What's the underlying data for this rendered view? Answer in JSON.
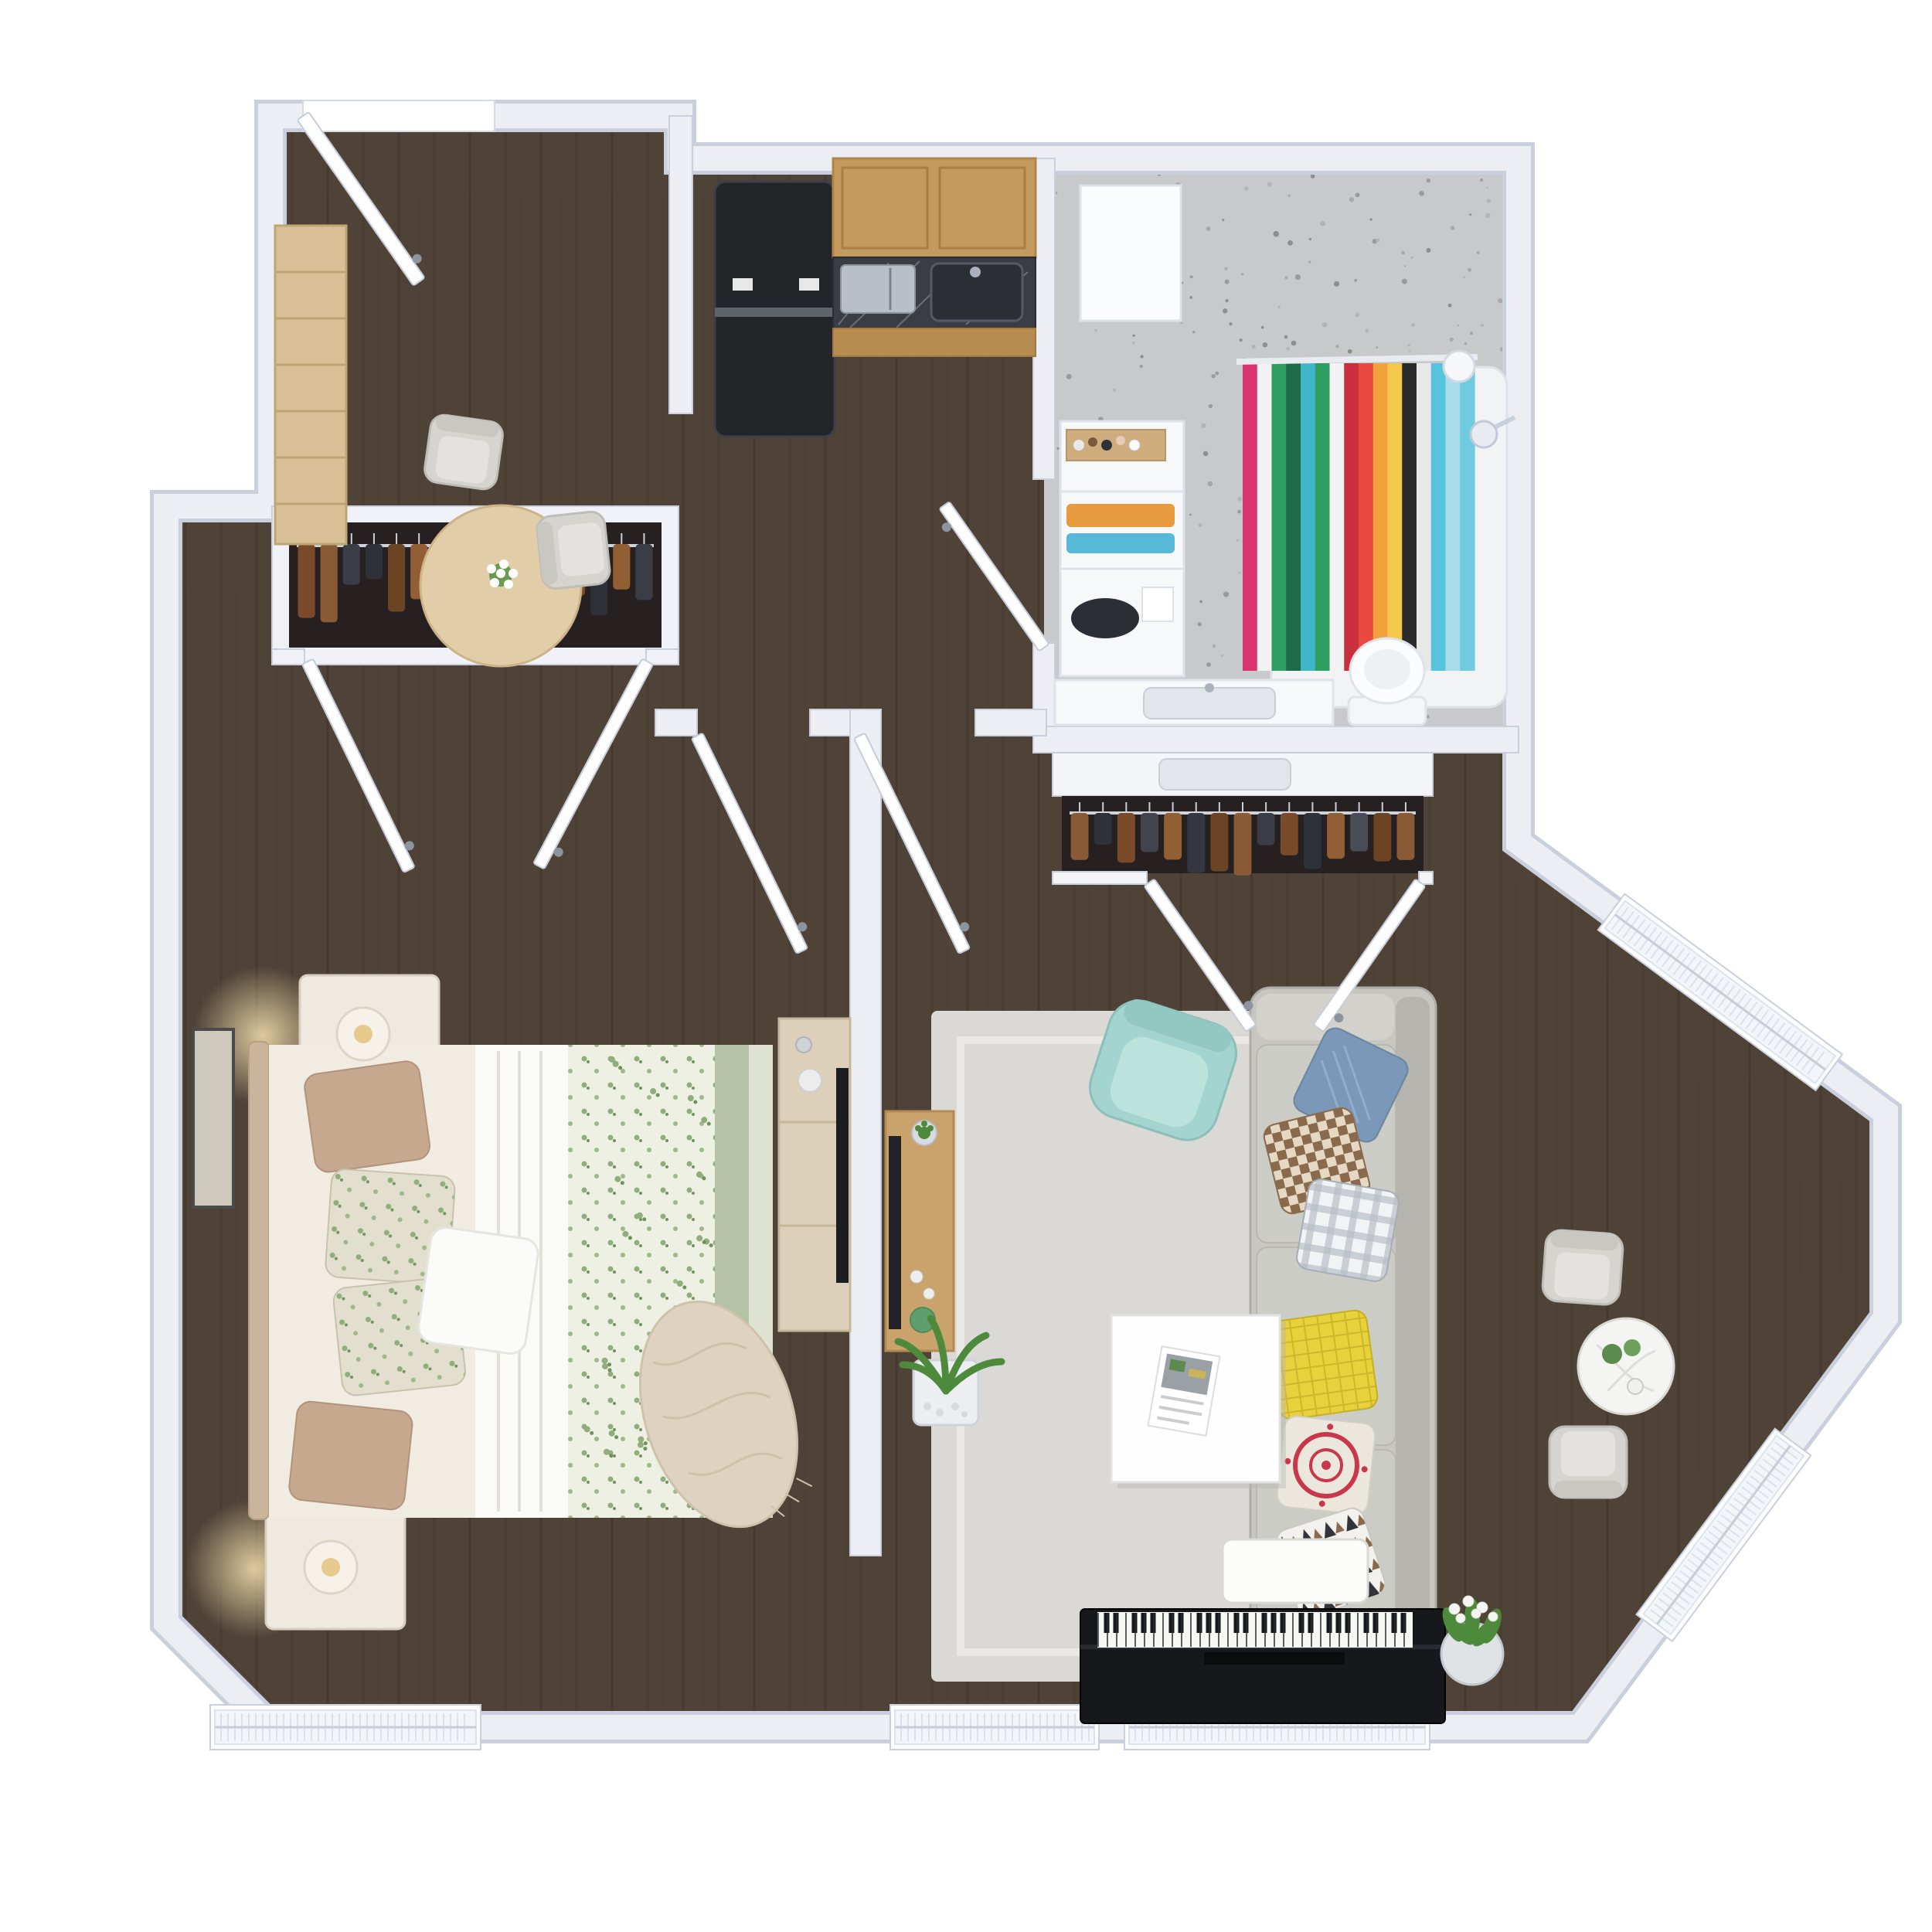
{
  "scene": {
    "kind": "3d-apartment-floor-plan-render",
    "background": "#ffffff"
  },
  "palette": {
    "floor_wood": "#4f4237",
    "plank_line": "#3f342a",
    "plank_light": "#5d4d3e",
    "wall_fill": "#eceef4",
    "wall_edge": "#c9cfdc",
    "bathroom_floor": "#c8c9ca",
    "rug": "#dad9d5",
    "white_furniture": "#fdfdfe"
  },
  "rooms": [
    {
      "name": "entry-dining-nook",
      "furniture": [
        "entry-door",
        "bookshelf",
        "dining-table",
        "dining-chair",
        "dining-chair",
        "flower-vase"
      ]
    },
    {
      "name": "kitchen",
      "furniture": [
        "refrigerator",
        "upper-cabinets",
        "marble-counter",
        "microwave",
        "kitchen-sink",
        "lower-cabinets"
      ]
    },
    {
      "name": "bathroom",
      "furniture": [
        "medicine-cabinet",
        "shelf-unit",
        "toiletries-tray",
        "towels",
        "shower-tray",
        "shower-curtain",
        "shower-head",
        "wall-light",
        "vanity-sink",
        "toilet"
      ]
    },
    {
      "name": "hallway",
      "furniture": [
        "bedroom-door",
        "living-room-door",
        "bathroom-door"
      ]
    },
    {
      "name": "bedroom",
      "furniture": [
        "double-bed",
        "floral-duvet",
        "throw-blanket",
        "pillows",
        "nightstand-lamp",
        "nightstand-lamp",
        "wall-art",
        "closet-with-clothes",
        "dresser",
        "tv",
        "window-blinds"
      ]
    },
    {
      "name": "living-room",
      "furniture": [
        "sofa",
        "sofa-pillows",
        "mint-armchair",
        "area-rug",
        "coffee-table",
        "magazine",
        "tv-console",
        "tv",
        "floor-plant",
        "closet-with-clothes",
        "bistro-table",
        "lounge-chair",
        "lounge-chair",
        "bay-windows"
      ]
    },
    {
      "name": "piano-nook",
      "furniture": [
        "upright-piano",
        "piano-bench",
        "tulip-plant",
        "window-blinds"
      ]
    }
  ],
  "kitchen": {
    "cabinet_wood": "#c49a5e",
    "cabinet_wood_dark": "#b08648",
    "counter_marble": "#3a3d44",
    "fridge": "#232529",
    "microwave": "#b9bec7"
  },
  "bathroom": {
    "shower_curtain": {
      "stripes": [
        "#d8356f",
        "#f2f2f2",
        "#2f9e63",
        "#1d6b4a",
        "#3fb7c9",
        "#2f9e63",
        "#f2f2f2",
        "#c92f3d",
        "#e84a3f",
        "#f2a23c",
        "#f4c84a",
        "#2b2b2b",
        "#e8e8e8",
        "#57c4de",
        "#a8dce8",
        "#6fcbe0"
      ]
    },
    "speckle_colors": [
      "#9b9b9b",
      "#a8a8a8",
      "#8e8e8e",
      "#b4b4b4"
    ],
    "towel_colors": [
      "#e89a3f",
      "#58b8d8"
    ]
  },
  "closets": {
    "bedroom_closet": {
      "count": 16,
      "clothes": [
        "#7a4a2a",
        "#8a5a36",
        "#3a3d45",
        "#2f3138",
        "#6b4423",
        "#915f33",
        "#42454e",
        "#7a4a2a",
        "#343741",
        "#8a5a36",
        "#4a4d57",
        "#6b4423",
        "#7a4a2a",
        "#2f3138",
        "#915f33",
        "#3a3d45"
      ]
    },
    "living_closet": {
      "count": 15,
      "clothes": [
        "#8a5a36",
        "#2f3138",
        "#7a4a2a",
        "#42454e",
        "#915f33",
        "#343741",
        "#6b4423",
        "#8a5a36",
        "#3a3d45",
        "#7a4a2a",
        "#2f3138",
        "#915f33",
        "#4a4d57",
        "#6b4423",
        "#8a5a36"
      ]
    }
  },
  "bedroom": {
    "duvet_base": "#eef0e3",
    "sheet_fold": "#fafaf6",
    "sage_stripe": "#b5c2a6",
    "sage_stripe_light": "#dde3d0",
    "pillow_tan": "#c6a88f",
    "pillow_floral": "#e3dfcf",
    "pillow_white": "#fbfbf9",
    "headboard": "#cbb49c",
    "throw": "#ded3c0",
    "dresser_wood": "#ddd0ba",
    "lamp_glow": "#f7e3b0"
  },
  "living_room": {
    "armchair_color": "#a4d4cf",
    "armchair_seat": "#bce2dc",
    "sofa_color": "#c7c6c1",
    "rug_color": "#dad9d5",
    "console_wood": "#c9a36b",
    "sofa": {
      "pillows": [
        {
          "name": "denim-pillow",
          "color": "#7b98b8"
        },
        {
          "name": "checker-pillow",
          "color": "#9c7a5c"
        },
        {
          "name": "gingham-pillow",
          "color": "#c6cbd3"
        },
        {
          "name": "yellow-pillow",
          "color": "#e8d23c"
        },
        {
          "name": "medallion-pillow",
          "color": "#ece7dd"
        },
        {
          "name": "triangle-pillow",
          "color": "#f2f1ed"
        }
      ]
    }
  },
  "piano": {
    "body": "#17181b",
    "keys": "#f7f7f4",
    "key_count": 34,
    "bench": "#fcfcfb"
  },
  "windows": [
    "bedroom-window",
    "hall-window",
    "piano-window",
    "bay-window-upper",
    "bay-window-lower"
  ],
  "doors": [
    "entry-door",
    "bathroom-door",
    "bedroom-door",
    "living-room-door",
    "bedroom-closet-doors",
    "living-closet-doors"
  ],
  "plants": {
    "leaf": "#4e8a3c",
    "leaf_light": "#6aa34e",
    "tulip": "#f5f6f2"
  }
}
